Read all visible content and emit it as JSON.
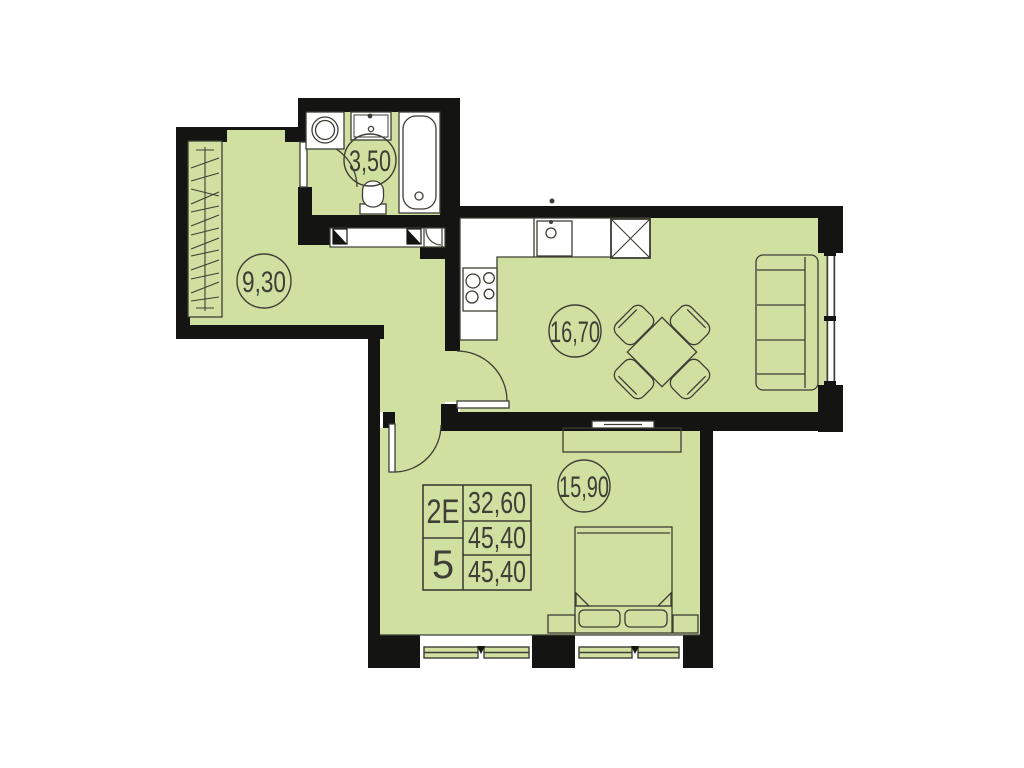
{
  "plan": {
    "rooms": [
      {
        "id": "bathroom",
        "area_label": "3,50"
      },
      {
        "id": "hallway",
        "area_label": "9,30"
      },
      {
        "id": "kitchen-living",
        "area_label": "16,70"
      },
      {
        "id": "bedroom",
        "area_label": "15,90"
      }
    ],
    "info_table": {
      "flat_type": "2E",
      "flat_number": "5",
      "living_area": "32,60",
      "area_no_summer": "45,40",
      "total_area": "45,40"
    },
    "colors": {
      "floor": "#cfe0a1",
      "wall": "#141412",
      "line": "#3e3e36",
      "fixture_fill": "#ffffff",
      "background": "#ffffff"
    }
  }
}
